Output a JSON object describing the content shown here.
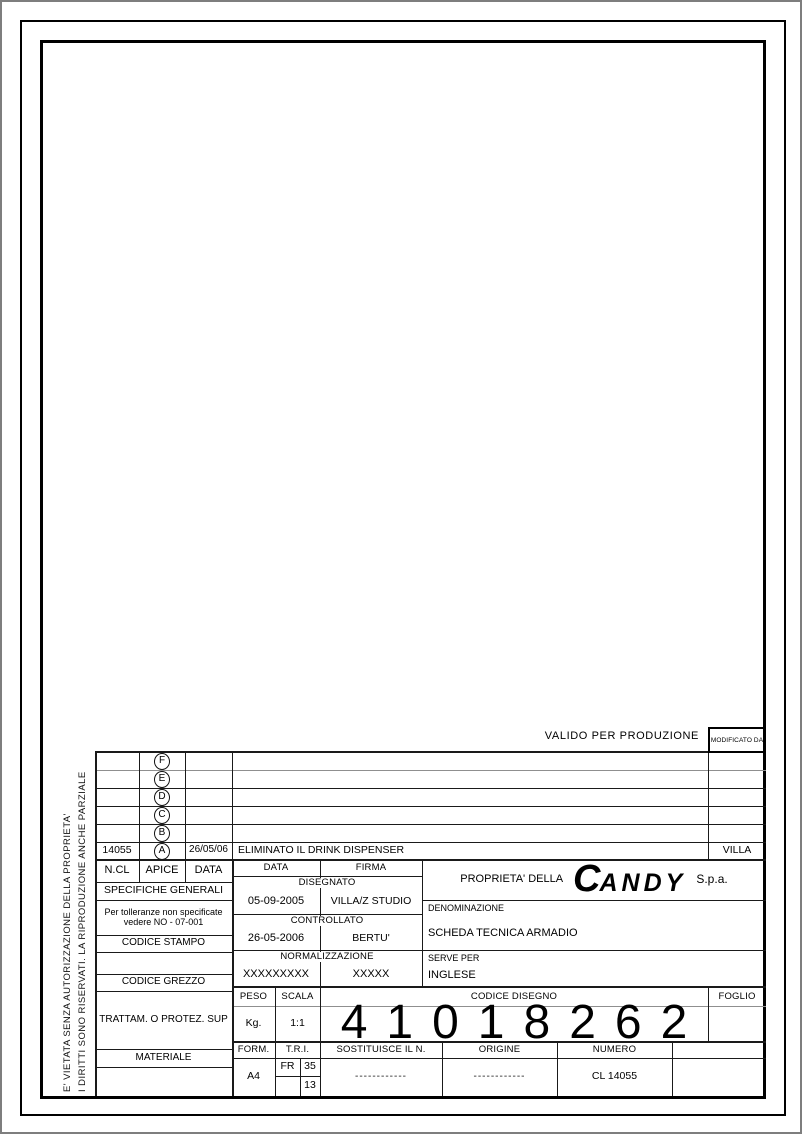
{
  "sheet": {
    "valido_label": "VALIDO PER PRODUZIONE",
    "modificato_label": "MODIFICATO DA"
  },
  "side_note": {
    "line1": "I DIRITTI SONO RISERVATI. LA RIPRODUZIONE ANCHE PARZIALE",
    "line2": "E' VIETATA SENZA AUTORIZZAZIONE DELLA PROPRIETA'"
  },
  "revisions": {
    "header": {
      "ncl": "N.CL",
      "apice": "APICE",
      "data": "DATA"
    },
    "rows": [
      {
        "ncl": "",
        "apice": "F",
        "data": "",
        "description": "",
        "modified_by": ""
      },
      {
        "ncl": "",
        "apice": "E",
        "data": "",
        "description": "",
        "modified_by": ""
      },
      {
        "ncl": "",
        "apice": "D",
        "data": "",
        "description": "",
        "modified_by": ""
      },
      {
        "ncl": "",
        "apice": "C",
        "data": "",
        "description": "",
        "modified_by": ""
      },
      {
        "ncl": "",
        "apice": "B",
        "data": "",
        "description": "",
        "modified_by": ""
      },
      {
        "ncl": "14055",
        "apice": "A",
        "data": "26/05/06",
        "description": "ELIMINATO IL DRINK DISPENSER",
        "modified_by": "VILLA"
      }
    ]
  },
  "general": {
    "specifiche_title": "SPECIFICHE GENERALI",
    "tolerance_note_line1": "Per tolleranze non specificate",
    "tolerance_note_line2": "vedere NO - 07-001",
    "codice_stampo_label": "CODICE STAMPO",
    "codice_grezzo_label": "CODICE GREZZO",
    "trattamento_label": "TRATTAM. O PROTEZ. SUP",
    "materiale_label": "MATERIALE"
  },
  "signatures": {
    "data_label": "DATA",
    "firma_label": "FIRMA",
    "disegnato_label": "DISEGNATO",
    "disegnato_data": "05-09-2005",
    "disegnato_firma": "VILLA/Z STUDIO",
    "controllato_label": "CONTROLLATO",
    "controllato_data": "26-05-2006",
    "controllato_firma": "BERTU'",
    "normalizzazione_label": "NORMALIZZAZIONE",
    "normalizzazione_data": "XXXXXXXXX",
    "normalizzazione_firma": "XXXXX"
  },
  "company": {
    "proprieta_label": "PROPRIETA' DELLA",
    "logo_initial": "C",
    "logo_rest": "ANDY",
    "suffix": "S.p.a.",
    "denominazione_label": "DENOMINAZIONE",
    "denominazione_value": "SCHEDA TECNICA ARMADIO",
    "serve_per_label": "SERVE PER",
    "serve_per_value": "INGLESE"
  },
  "drawing": {
    "peso_label": "PESO",
    "peso_value": "Kg.",
    "scala_label": "SCALA",
    "scala_value": "1:1",
    "codice_disegno_label": "CODICE DISEGNO",
    "codice_disegno_value": "41018262",
    "foglio_label": "FOGLIO",
    "foglio_value": ""
  },
  "footer": {
    "form_label": "FORM.",
    "form_value": "A4",
    "tri_label": "T.R.I.",
    "tri_top_left": "FR",
    "tri_top_right": "35",
    "tri_bottom_right": "13",
    "sostituisce_label": "SOSTITUISCE IL N.",
    "sostituisce_value": "------------",
    "origine_label": "ORIGINE",
    "origine_value": "------------",
    "numero_label": "NUMERO",
    "numero_value": "CL 14055"
  }
}
